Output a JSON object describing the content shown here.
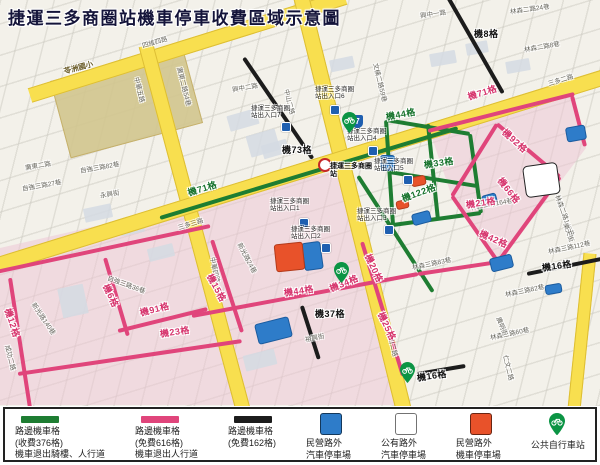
{
  "title": "捷運三多商圈站機車停車收費區域示意圖",
  "colors": {
    "paid_line": "#1e7d32",
    "free_line": "#e0457b",
    "free_line2": "#1c1c1c",
    "road_yellow": "#f8df4f",
    "private_car_park": "#2e7cc9",
    "public_car_park": "#ffffff",
    "private_moto_park": "#e8522a",
    "bike_station": "#0b9444"
  },
  "legend": {
    "items": [
      {
        "type": "line",
        "color": "#1e7d32",
        "lines": [
          "路邊機車格",
          "(收費376格)",
          "機車退出騎樓、人行道"
        ]
      },
      {
        "type": "line",
        "color": "#e0457b",
        "lines": [
          "路邊機車格",
          "(免費616格)",
          "機車退出人行道"
        ]
      },
      {
        "type": "line",
        "color": "#1c1c1c",
        "lines": [
          "路邊機車格",
          "(免費162格)"
        ]
      },
      {
        "type": "square",
        "color": "#2e7cc9",
        "lines": [
          "民營路外",
          "汽車停車場"
        ]
      },
      {
        "type": "square",
        "color": "#ffffff",
        "lines": [
          "公有路外",
          "汽車停車場"
        ]
      },
      {
        "type": "square",
        "color": "#e8522a",
        "lines": [
          "民營路外",
          "機車停車場"
        ]
      },
      {
        "type": "pin",
        "color": "#0b9444",
        "lines": [
          "公共自行車站"
        ]
      }
    ]
  },
  "station": {
    "name": "捷運三多商圈站",
    "x": 330,
    "y": 163,
    "icon_x": 318,
    "icon_y": 158,
    "shield": "7",
    "shield_x": 352,
    "shield_y": 115,
    "exits": [
      {
        "t": "捷運三多商圈站出入口1",
        "x": 270,
        "y": 198,
        "mx": 299,
        "my": 218
      },
      {
        "t": "捷運三多商圈站出入口2",
        "x": 291,
        "y": 226,
        "mx": 321,
        "my": 243
      },
      {
        "t": "捷運三多商圈站出入口3",
        "x": 357,
        "y": 208,
        "mx": 384,
        "my": 225
      },
      {
        "t": "捷運三多商圈站出入口4",
        "x": 347,
        "y": 128,
        "mx": 368,
        "my": 146
      },
      {
        "t": "捷運三多商圈站出入口5",
        "x": 374,
        "y": 158,
        "mx": 403,
        "my": 175
      },
      {
        "t": "捷運三多商圈站出入口6",
        "x": 315,
        "y": 86,
        "mx": 330,
        "my": 105
      },
      {
        "t": "捷運三多商圈站出入口7",
        "x": 251,
        "y": 105,
        "mx": 281,
        "my": 122
      }
    ]
  },
  "map": {
    "washes": [
      "0,248 340,170 360,238 402,405 0,405",
      "430,132 572,94 586,148 498,264 452,197"
    ],
    "school": {
      "label": "苓洲國小",
      "x": 58,
      "y": 62,
      "w": 135,
      "h": 78,
      "r": -15,
      "lx": 64,
      "ly": 66
    },
    "buildings": [
      {
        "x": 228,
        "y": 112,
        "w": 30,
        "h": 16,
        "r": -16
      },
      {
        "x": 262,
        "y": 142,
        "w": 26,
        "h": 14,
        "r": -16
      },
      {
        "x": 84,
        "y": 206,
        "w": 28,
        "h": 14,
        "r": -12
      },
      {
        "x": 120,
        "y": 222,
        "w": 24,
        "h": 12,
        "r": -12
      },
      {
        "x": 430,
        "y": 52,
        "w": 26,
        "h": 13,
        "r": -10
      },
      {
        "x": 466,
        "y": 42,
        "w": 22,
        "h": 12,
        "r": -10
      },
      {
        "x": 244,
        "y": 352,
        "w": 32,
        "h": 16,
        "r": -14
      },
      {
        "x": 60,
        "y": 286,
        "w": 26,
        "h": 30,
        "r": -12
      },
      {
        "x": 252,
        "y": 128,
        "w": 22,
        "h": 30,
        "r": 74
      },
      {
        "x": 506,
        "y": 60,
        "w": 24,
        "h": 12,
        "r": -10
      },
      {
        "x": 148,
        "y": 246,
        "w": 26,
        "h": 13,
        "r": -14
      },
      {
        "x": 330,
        "y": 58,
        "w": 24,
        "h": 12,
        "r": -12
      }
    ],
    "roads_yellow": [
      {
        "p": [
          30,
          94,
          345,
          -4
        ],
        "w": 13
      },
      {
        "p": [
          146,
          44,
          243,
          408
        ],
        "w": 13
      },
      {
        "p": [
          301,
          -5,
          404,
          410
        ],
        "w": 14
      },
      {
        "p": [
          -5,
          265,
          605,
          76
        ],
        "w": 14
      },
      {
        "p": [
          590,
          252,
          574,
          408
        ],
        "w": 11
      }
    ],
    "lines_green": [
      [
        160,
        218,
        458,
        128
      ],
      [
        386,
        120,
        470,
        134
      ],
      [
        470,
        134,
        481,
        213
      ],
      [
        481,
        213,
        393,
        225
      ],
      [
        393,
        225,
        386,
        120
      ],
      [
        389,
        172,
        477,
        186
      ],
      [
        428,
        124,
        438,
        220
      ],
      [
        358,
        176,
        433,
        292
      ]
    ],
    "lines_pink": [
      [
        428,
        131,
        574,
        94
      ],
      [
        572,
        96,
        585,
        146
      ],
      [
        497,
        124,
        560,
        177
      ],
      [
        560,
        177,
        498,
        262
      ],
      [
        497,
        124,
        452,
        196
      ],
      [
        452,
        196,
        498,
        262
      ],
      [
        498,
        262,
        418,
        274
      ],
      [
        418,
        274,
        192,
        316
      ],
      [
        212,
        240,
        242,
        332
      ],
      [
        -4,
        272,
        210,
        226
      ],
      [
        10,
        278,
        30,
        408
      ],
      [
        18,
        374,
        242,
        341
      ],
      [
        105,
        258,
        128,
        336
      ],
      [
        118,
        331,
        207,
        309
      ],
      [
        362,
        242,
        403,
        376
      ]
    ],
    "lines_black": [
      [
        244,
        58,
        313,
        159
      ],
      [
        448,
        -3,
        503,
        93
      ],
      [
        527,
        274,
        601,
        259
      ],
      [
        302,
        306,
        319,
        359
      ],
      [
        417,
        374,
        465,
        366
      ]
    ],
    "zones_green": [
      {
        "t": "機71格",
        "x": 188,
        "y": 186,
        "r": -17
      },
      {
        "t": "機44格",
        "x": 386,
        "y": 110,
        "r": -10
      },
      {
        "t": "機33格",
        "x": 424,
        "y": 158,
        "r": -8
      },
      {
        "t": "機122格",
        "x": 402,
        "y": 192,
        "r": -20
      }
    ],
    "zones_pink": [
      {
        "t": "機71格",
        "x": 468,
        "y": 90,
        "r": -17
      },
      {
        "t": "機92格",
        "x": 504,
        "y": 124,
        "r": 42
      },
      {
        "t": "機66格",
        "x": 500,
        "y": 172,
        "r": 52
      },
      {
        "t": "機21格",
        "x": 466,
        "y": 198,
        "r": -8
      },
      {
        "t": "機42格",
        "x": 480,
        "y": 226,
        "r": 24
      },
      {
        "t": "機15格",
        "x": 210,
        "y": 268,
        "r": 62
      },
      {
        "t": "機44格",
        "x": 284,
        "y": 286,
        "r": -8
      },
      {
        "t": "機34格",
        "x": 330,
        "y": 282,
        "r": -22
      },
      {
        "t": "機20格",
        "x": 368,
        "y": 248,
        "r": 65
      },
      {
        "t": "機25格",
        "x": 381,
        "y": 306,
        "r": 65
      },
      {
        "t": "機12格",
        "x": 8,
        "y": 302,
        "r": 72
      },
      {
        "t": "機6格",
        "x": 106,
        "y": 278,
        "r": 65
      },
      {
        "t": "機91格",
        "x": 140,
        "y": 306,
        "r": -14
      },
      {
        "t": "機23格",
        "x": 160,
        "y": 327,
        "r": -8
      }
    ],
    "zones_black": [
      {
        "t": "機73格",
        "x": 282,
        "y": 143,
        "r": 0
      },
      {
        "t": "機8格",
        "x": 474,
        "y": 27,
        "r": 0
      },
      {
        "t": "機16格",
        "x": 542,
        "y": 261,
        "r": -8
      },
      {
        "t": "機37格",
        "x": 315,
        "y": 307,
        "r": 0
      },
      {
        "t": "機16格",
        "x": 417,
        "y": 371,
        "r": -8
      }
    ],
    "streets": [
      {
        "t": "四維四路",
        "x": 142,
        "y": 40,
        "r": -16
      },
      {
        "t": "中華五路",
        "x": 137,
        "y": 72,
        "r": 76
      },
      {
        "t": "中華四路",
        "x": 213,
        "y": 252,
        "r": 78
      },
      {
        "t": "中山二路",
        "x": 287,
        "y": 84,
        "r": 76
      },
      {
        "t": "中山二路",
        "x": 390,
        "y": 326,
        "r": 76
      },
      {
        "t": "三多二路",
        "x": 548,
        "y": 78,
        "r": -17
      },
      {
        "t": "三多三路",
        "x": 178,
        "y": 222,
        "r": -17
      },
      {
        "t": "興中一路",
        "x": 420,
        "y": 10,
        "r": -8
      },
      {
        "t": "興中二路",
        "x": 232,
        "y": 84,
        "r": -10
      },
      {
        "t": "文橫二路59巷",
        "x": 376,
        "y": 58,
        "r": 76
      },
      {
        "t": "林森二路24巷",
        "x": 510,
        "y": 6,
        "r": -8
      },
      {
        "t": "林森二路8巷",
        "x": 524,
        "y": 44,
        "r": -10
      },
      {
        "t": "廣東二路",
        "x": 25,
        "y": 162,
        "r": -10
      },
      {
        "t": "廣東二路54巷",
        "x": 180,
        "y": 62,
        "r": 76
      },
      {
        "t": "自強三路82巷",
        "x": 80,
        "y": 165,
        "r": -10
      },
      {
        "t": "自強三路27巷",
        "x": 22,
        "y": 183,
        "r": -10
      },
      {
        "t": "永興街",
        "x": 100,
        "y": 190,
        "r": -10
      },
      {
        "t": "成功二路",
        "x": 8,
        "y": 340,
        "r": 76
      },
      {
        "t": "新光路24巷",
        "x": 240,
        "y": 238,
        "r": 62
      },
      {
        "t": "新光路140巷",
        "x": 34,
        "y": 298,
        "r": 56
      },
      {
        "t": "自強三路36巷",
        "x": 108,
        "y": 272,
        "r": 20
      },
      {
        "t": "林森二路164巷",
        "x": 470,
        "y": 202,
        "r": -10
      },
      {
        "t": "林森二路148巷",
        "x": 558,
        "y": 190,
        "r": 70
      },
      {
        "t": "樂天街",
        "x": 566,
        "y": 218,
        "r": 70
      },
      {
        "t": "林森三路112巷",
        "x": 548,
        "y": 246,
        "r": -12
      },
      {
        "t": "林森三路83巷",
        "x": 412,
        "y": 262,
        "r": -12
      },
      {
        "t": "林森三路82巷",
        "x": 505,
        "y": 289,
        "r": -12
      },
      {
        "t": "林森三路60巷",
        "x": 490,
        "y": 332,
        "r": -12
      },
      {
        "t": "廣明街",
        "x": 499,
        "y": 312,
        "r": 68
      },
      {
        "t": "仁文二路",
        "x": 506,
        "y": 350,
        "r": 76
      },
      {
        "t": "裕興街",
        "x": 305,
        "y": 334,
        "r": -12
      }
    ],
    "parking_private_car": [
      {
        "x": 380,
        "y": 155,
        "w": 13,
        "h": 14,
        "r": 0
      },
      {
        "x": 566,
        "y": 126,
        "w": 18,
        "h": 13,
        "r": -10
      },
      {
        "x": 303,
        "y": 242,
        "w": 17,
        "h": 26,
        "r": -8
      },
      {
        "x": 412,
        "y": 212,
        "w": 17,
        "h": 10,
        "r": -15
      },
      {
        "x": 482,
        "y": 194,
        "w": 13,
        "h": 9,
        "r": -15
      },
      {
        "x": 256,
        "y": 320,
        "w": 33,
        "h": 19,
        "r": -14
      },
      {
        "x": 490,
        "y": 256,
        "w": 21,
        "h": 12,
        "r": -14
      },
      {
        "x": 545,
        "y": 284,
        "w": 15,
        "h": 8,
        "r": -10
      }
    ],
    "parking_public_car": [
      {
        "x": 524,
        "y": 164,
        "w": 33,
        "h": 30,
        "r": -8
      }
    ],
    "parking_private_moto": [
      {
        "x": 275,
        "y": 243,
        "w": 27,
        "h": 26,
        "r": -6
      },
      {
        "x": 411,
        "y": 176,
        "w": 13,
        "h": 8,
        "r": -12
      },
      {
        "x": 396,
        "y": 200,
        "w": 11,
        "h": 7,
        "r": -12
      }
    ],
    "bike_stations": [
      [
        342,
        112
      ],
      [
        334,
        262
      ],
      [
        400,
        362
      ]
    ]
  }
}
